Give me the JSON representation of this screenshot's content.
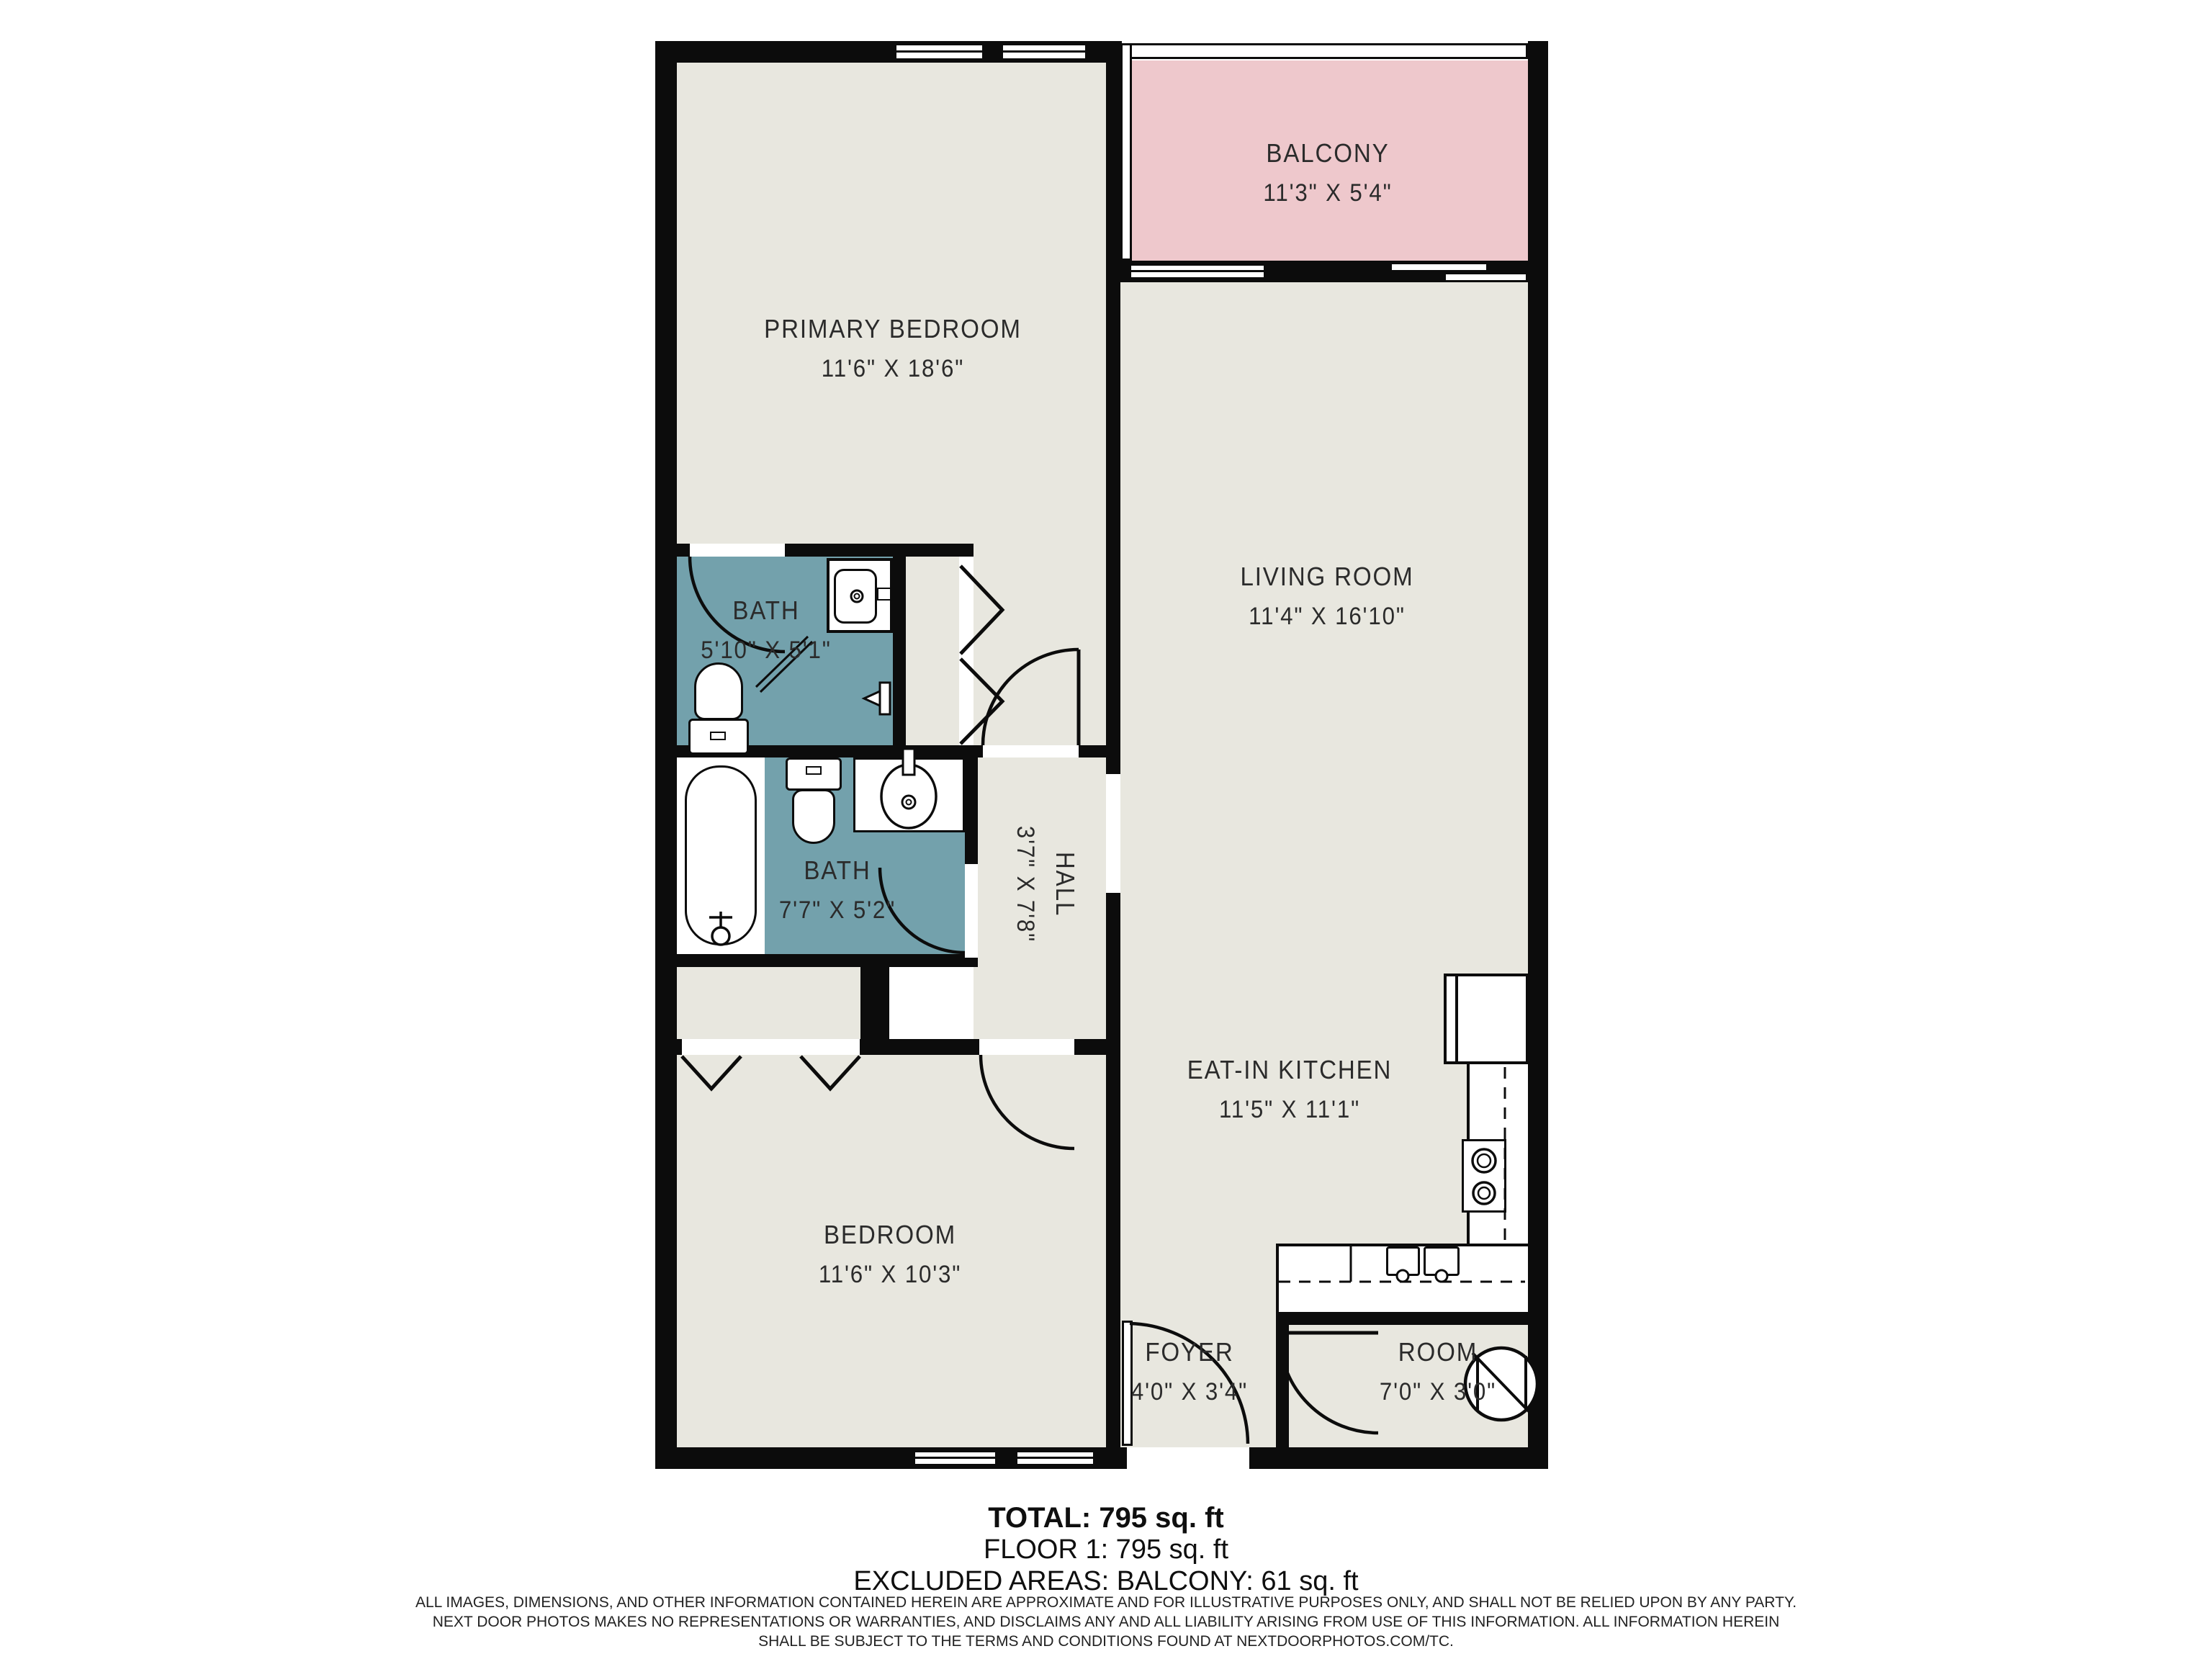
{
  "colors": {
    "wall": "#0c0c0c",
    "floor": "#e8e7df",
    "bath": "#73a1ac",
    "balcony": "#eec8cc",
    "label_text": "#2b2b2b"
  },
  "rooms": {
    "primary": {
      "name": "PRIMARY BEDROOM",
      "dims": "11'6\" X 18'6\""
    },
    "balcony": {
      "name": "BALCONY",
      "dims": "11'3\" X 5'4\""
    },
    "living": {
      "name": "LIVING ROOM",
      "dims": "11'4\" X 16'10\""
    },
    "bath1": {
      "name": "BATH",
      "dims": "5'10\" X 5'1\""
    },
    "bath2": {
      "name": "BATH",
      "dims": "7'7\" X 5'2\""
    },
    "hall": {
      "name": "HALL",
      "dims": "3'7\" X 7'8\""
    },
    "kitchen": {
      "name": "EAT-IN KITCHEN",
      "dims": "11'5\" X 11'1\""
    },
    "bedroom": {
      "name": "BEDROOM",
      "dims": "11'6\" X 10'3\""
    },
    "foyer": {
      "name": "FOYER",
      "dims": "4'0\" X 3'4\""
    },
    "room": {
      "name": "ROOM",
      "dims": "7'0\" X 3'0\""
    }
  },
  "summary": {
    "total": "TOTAL: 795 sq. ft",
    "floor": "FLOOR 1: 795 sq. ft",
    "excluded": "EXCLUDED AREAS: BALCONY: 61 sq. ft"
  },
  "disclaimer": {
    "line1": "ALL IMAGES, DIMENSIONS, AND OTHER INFORMATION CONTAINED HEREIN ARE APPROXIMATE AND FOR ILLUSTRATIVE PURPOSES ONLY, AND SHALL NOT BE RELIED UPON BY ANY PARTY.",
    "line2": "NEXT DOOR PHOTOS MAKES NO REPRESENTATIONS OR WARRANTIES, AND DISCLAIMS ANY AND ALL LIABILITY ARISING FROM USE OF THIS INFORMATION. ALL INFORMATION HEREIN",
    "line3": "SHALL BE SUBJECT TO THE TERMS AND CONDITIONS FOUND AT NEXTDOORPHOTOS.COM/TC."
  }
}
